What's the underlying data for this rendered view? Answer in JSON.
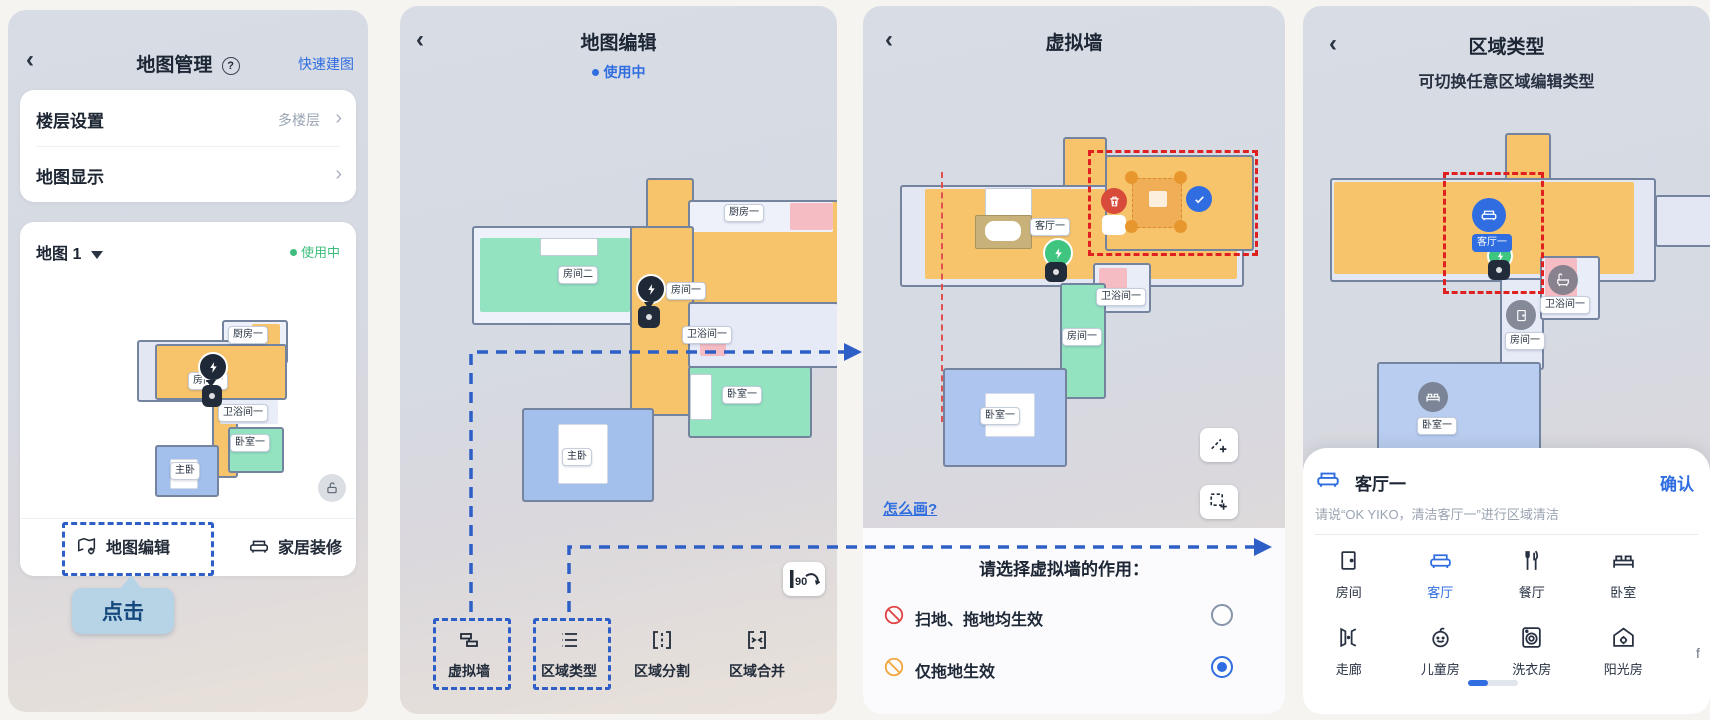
{
  "colors": {
    "accent_blue": "#2f6de0",
    "status_green": "#3dbd7d",
    "annotation_blue_dash": "#2d5fc7",
    "annotation_red_dash": "#e02020",
    "room_orange": "#f7c46c",
    "room_mint": "#93e2c0",
    "room_blue": "#a3bfec",
    "room_pink": "#f6bcc4"
  },
  "panel1": {
    "back": "‹",
    "title": "地图管理",
    "help": "?",
    "quick_build": "快速建图",
    "rows": [
      {
        "label": "楼层设置",
        "value": "多楼层"
      },
      {
        "label": "地图显示",
        "value": ""
      }
    ],
    "map_name": "地图 1",
    "status": "使用中",
    "rooms": {
      "kitchen": "厨房一",
      "room1": "房间一",
      "bath": "卫浴间一",
      "bedroom": "卧室一",
      "master": "主卧"
    },
    "edit_button": "地图编辑",
    "decor_button": "家居装修",
    "callout": "点击"
  },
  "panel2": {
    "back": "‹",
    "title": "地图编辑",
    "status": "使用中",
    "rooms": {
      "kitchen": "厨房一",
      "room2": "房间二",
      "room1": "房间一",
      "bath": "卫浴间一",
      "bedroom": "卧室一",
      "master": "主卧"
    },
    "rotate_badge": "90",
    "toolbar": [
      {
        "label": "虚拟墙"
      },
      {
        "label": "区域类型"
      },
      {
        "label": "区域分割"
      },
      {
        "label": "区域合并"
      }
    ]
  },
  "panel3": {
    "back": "‹",
    "title": "虚拟墙",
    "rooms": {
      "living": "客厅一",
      "bath": "卫浴间一",
      "room1": "房间一",
      "bedroom": "卧室一"
    },
    "how_to": "怎么画?",
    "prompt": "请选择虚拟墙的作用：",
    "options": [
      {
        "label": "扫地、拖地均生效",
        "selected": false
      },
      {
        "label": "仅拖地生效",
        "selected": true
      }
    ]
  },
  "panel4": {
    "back": "‹",
    "title": "区域类型",
    "subtitle": "可切换任意区域编辑类型",
    "rooms": {
      "living": "客厅一",
      "bath": "卫浴间一",
      "room1": "房间一",
      "bedroom": "卧室一"
    },
    "sheet": {
      "room_name": "客厅一",
      "confirm": "确认",
      "hint": "请说“OK YIKO，清洁客厅一”进行区域清洁",
      "types": [
        {
          "label": "房间"
        },
        {
          "label": "客厅"
        },
        {
          "label": "餐厅"
        },
        {
          "label": "卧室"
        },
        {
          "label": "走廊"
        },
        {
          "label": "儿童房"
        },
        {
          "label": "洗衣房"
        },
        {
          "label": "阳光房"
        }
      ],
      "selected_type": "客厅",
      "cutoff_text": "f"
    }
  }
}
